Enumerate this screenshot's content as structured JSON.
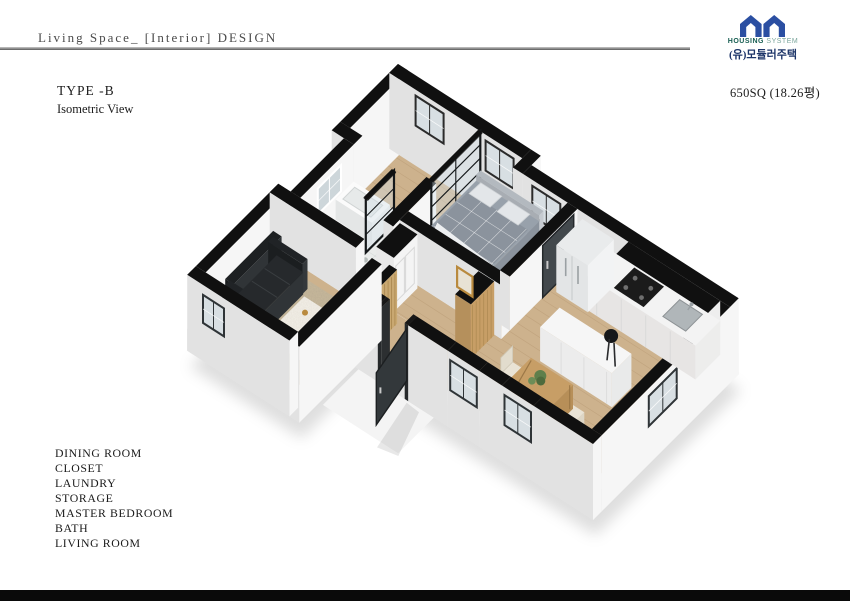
{
  "header": {
    "title": "Living Space_ [Interior] DESIGN"
  },
  "logo": {
    "line1_left": "HOUSING",
    "line1_right": "SYSTEM",
    "line2": "(유)모듈러주택",
    "mark_color": "#2b4fa2",
    "housing_color": "#175e52",
    "system_color": "#7ba69c",
    "company_color": "#1c3468"
  },
  "info": {
    "type": "TYPE -B",
    "view": "Isometric View",
    "area": "650SQ (18.26평)"
  },
  "rooms": [
    "DINING ROOM",
    "CLOSET",
    "LAUNDRY",
    "STORAGE",
    "MASTER BEDROOM",
    "BATH",
    "LIVING ROOM"
  ],
  "plan": {
    "colors": {
      "wallTop": "#101010",
      "faceA": "#f6f6f6",
      "faceB": "#e2e2e2",
      "slabA": "#f1f1f1",
      "slabB": "#e7e7e7",
      "wood": "#cdb28d",
      "woodLine": "#b89a74",
      "bathFloor": "#e9ebea",
      "rug": "#c8b99c",
      "sofa": "#24272a",
      "marble": "#f4f1ea",
      "bedBlanket": "#8b939d",
      "counter": "#f3f3f3",
      "furnWood": "#c79e66",
      "chair": "#e9e3d5",
      "glass": "#d8dfe3",
      "door": "#42484c",
      "plant": "#5f7f4b",
      "gold": "#b98a3e"
    }
  }
}
